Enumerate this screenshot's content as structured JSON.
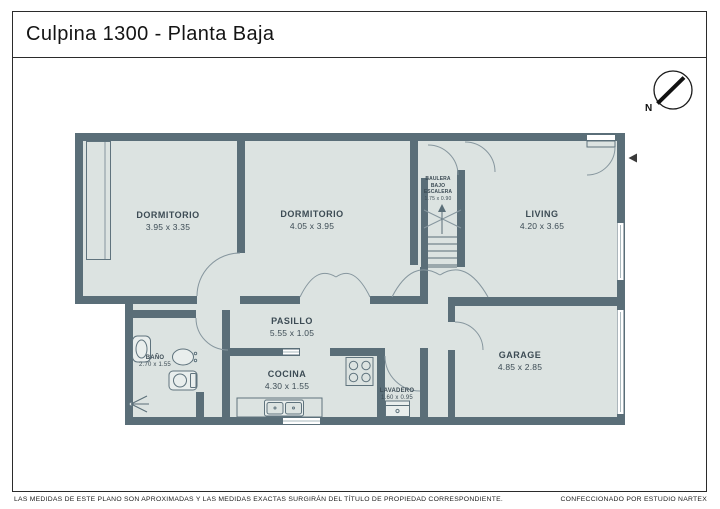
{
  "title": "Culpina 1300 - Planta Baja",
  "compass": {
    "label": "N"
  },
  "rooms": [
    {
      "id": "dormitorio-1",
      "name": "DORMITORIO",
      "dims": "3.95 x 3.35",
      "x": 168,
      "y": 210,
      "size": "normal"
    },
    {
      "id": "dormitorio-2",
      "name": "DORMITORIO",
      "dims": "4.05 x 3.95",
      "x": 312,
      "y": 209,
      "size": "normal"
    },
    {
      "id": "living",
      "name": "LIVING",
      "dims": "4.20 x 3.65",
      "x": 542,
      "y": 209,
      "size": "normal"
    },
    {
      "id": "pasillo",
      "name": "PASILLO",
      "dims": "5.55 x 1.05",
      "x": 292,
      "y": 316,
      "size": "normal"
    },
    {
      "id": "cocina",
      "name": "COCINA",
      "dims": "4.30 x 1.55",
      "x": 287,
      "y": 369,
      "size": "normal"
    },
    {
      "id": "garage",
      "name": "GARAGE",
      "dims": "4.85 x 2.85",
      "x": 520,
      "y": 350,
      "size": "normal"
    },
    {
      "id": "bano",
      "name": "BAÑO",
      "dims": "2.70 x 1.55",
      "x": 155,
      "y": 355,
      "size": "small"
    },
    {
      "id": "lavadero",
      "name": "LAVADERO",
      "dims": "1.60 x 0.95",
      "x": 397,
      "y": 388,
      "size": "small"
    },
    {
      "id": "baulera",
      "name": "BAULERA\nBAJO\nESCALERA",
      "dims": "1.75 x 0.90",
      "x": 438,
      "y": 176,
      "size": "tiny"
    }
  ],
  "footer": {
    "disclaimer": "LAS MEDIDAS  DE ESTE PLANO SON APROXIMADAS Y LAS MEDIDAS EXACTAS SURGIRÁN DEL TÍTULO DE PROPIEDAD CORRESPONDIENTE.",
    "credit": "CONFECCIONADO POR ESTUDIO NARTEX"
  },
  "colors": {
    "wall": "#5a6e78",
    "floor": "#dce3e1",
    "frame": "#2b2b2b",
    "label_text": "#3c4b54"
  }
}
